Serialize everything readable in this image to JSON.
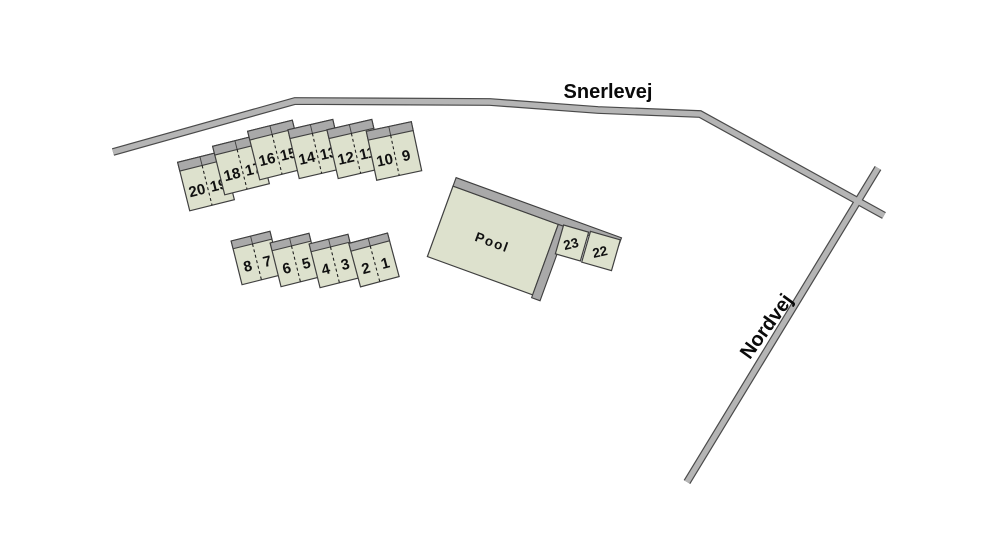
{
  "colors": {
    "background": "#ffffff",
    "road_fill": "#b5b5b5",
    "road_outline": "#4a4a4a",
    "building_fill": "#dde1cd",
    "roof_strip_fill": "#a9a9a9",
    "building_outline": "#3f3f3f",
    "label_color": "#111111"
  },
  "roads": {
    "snerlevej": {
      "label": "Snerlevej"
    },
    "nordvej": {
      "label": "Nordvej"
    }
  },
  "pool": {
    "label": "Pool"
  },
  "house_pairs": [
    {
      "left": "20",
      "right": "19"
    },
    {
      "left": "18",
      "right": "17"
    },
    {
      "left": "16",
      "right": "15"
    },
    {
      "left": "14",
      "right": "13"
    },
    {
      "left": "12",
      "right": "11"
    },
    {
      "left": "10",
      "right": "9"
    },
    {
      "left": "8",
      "right": "7"
    },
    {
      "left": "6",
      "right": "5"
    },
    {
      "left": "4",
      "right": "3"
    },
    {
      "left": "2",
      "right": "1"
    }
  ],
  "detached_houses": [
    {
      "label": "23"
    },
    {
      "label": "22"
    }
  ]
}
